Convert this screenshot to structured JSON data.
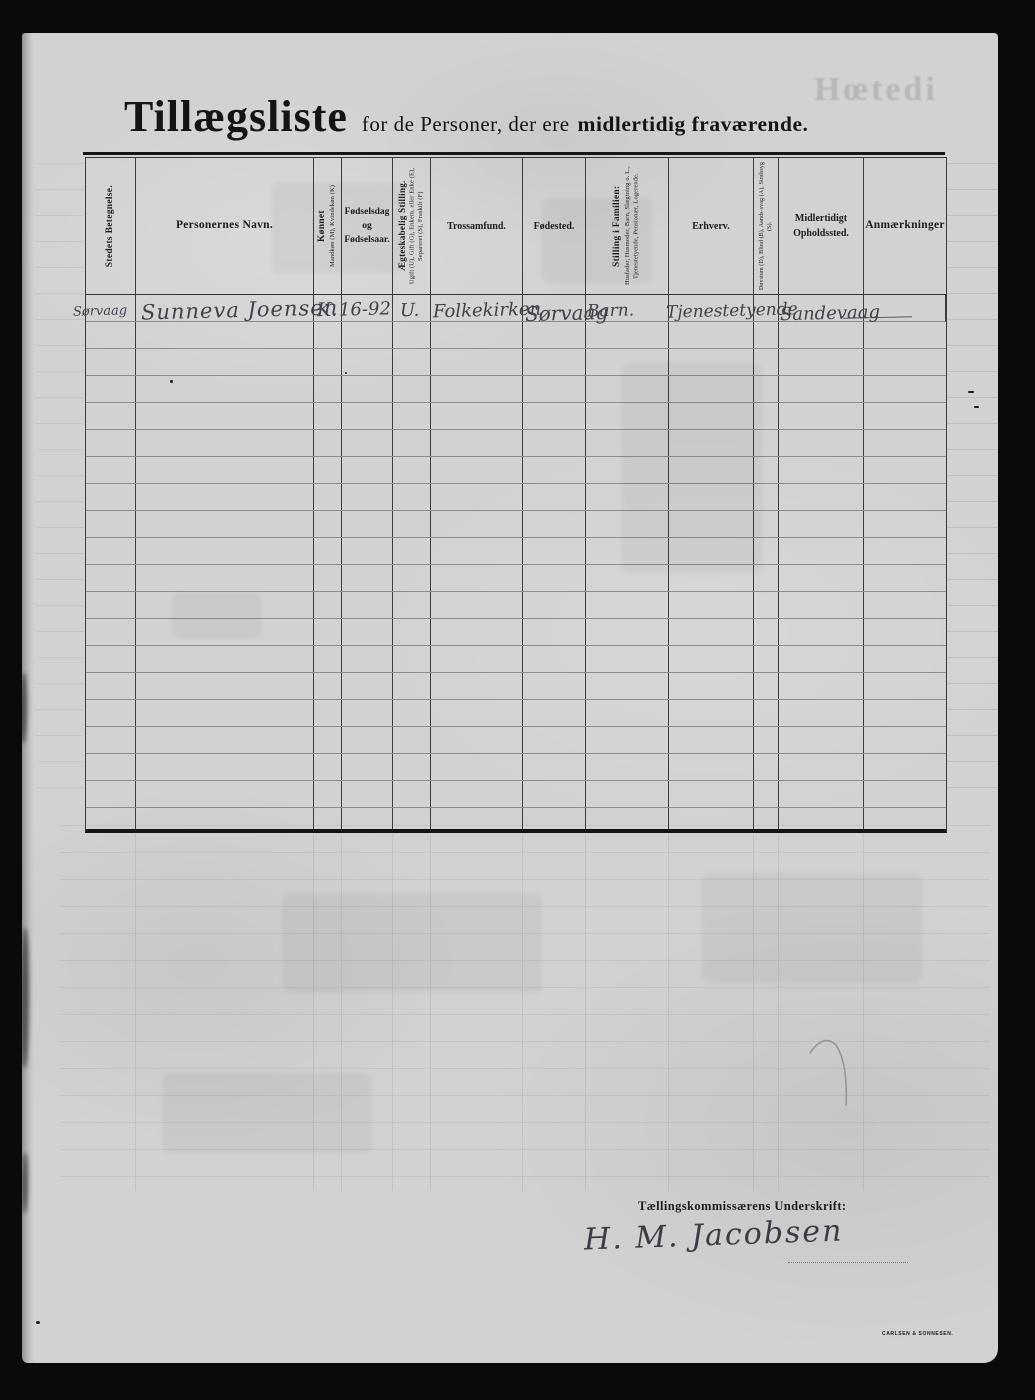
{
  "page": {
    "title_main": "Tillægsliste",
    "title_mid": "for de Personer, der ere",
    "title_bold": "midlertidig fraværende.",
    "ghost_text": "Hœtedi",
    "printer_mark": "CARLSEN & SONNESEN."
  },
  "table": {
    "columns": [
      {
        "id": "stedets",
        "label": "Stedets Betegnelse.",
        "orientation": "vertical"
      },
      {
        "id": "navn",
        "label": "Personernes Navn.",
        "orientation": "horizontal"
      },
      {
        "id": "konnet",
        "label": "Kønnet",
        "sub": "Mandkøn (M), Kvindekøn (K)",
        "orientation": "vertical"
      },
      {
        "id": "fodselsdag",
        "label": "Fødselsdag og Fødselsaar.",
        "orientation": "horizontal"
      },
      {
        "id": "aegteskabelig",
        "label": "Ægteskabelig Stilling.",
        "sub": "Ugift (U), Gift (G), Enkem. eller Enke (E), Separeret (S), Fraskilt (F)",
        "orientation": "vertical"
      },
      {
        "id": "trossamfund",
        "label": "Trossamfund.",
        "orientation": "horizontal"
      },
      {
        "id": "fodested",
        "label": "Fødested.",
        "orientation": "horizontal"
      },
      {
        "id": "stilling",
        "label": "Stilling i Familien:",
        "sub": "Husfader, Husmoder, Barn, Slægtning o. L., Tjenestetyende, Pensionær, Logerende.",
        "orientation": "vertical"
      },
      {
        "id": "erhverv",
        "label": "Erhverv.",
        "orientation": "horizontal"
      },
      {
        "id": "dovstum",
        "label": "Døvstum (D), Blind (B), Aands-svag (A), Sindssyg (S).",
        "orientation": "vertical"
      },
      {
        "id": "opholdssted",
        "label": "Midlertidigt Opholdssted.",
        "orientation": "horizontal"
      },
      {
        "id": "anmaerkninger",
        "label": "Anmærkninger",
        "orientation": "horizontal"
      }
    ],
    "rows": [
      {
        "stedets": "Sørvaag",
        "navn": "Sunneva Joensen",
        "konnet": "K.",
        "fodselsdag": "16-92",
        "aegteskabelig": "U.",
        "trossamfund": "Folkekirken",
        "fodested": "Sørvaag",
        "stilling": "Barn.",
        "erhverv": "Tjenestetyende",
        "dovstum": "",
        "opholdssted": "Sandevaag",
        "anmaerkninger": ""
      }
    ],
    "empty_row_count": 19
  },
  "signature": {
    "label": "Tællingskommissærens Underskrift:",
    "name": "H. M. Jacobsen"
  }
}
